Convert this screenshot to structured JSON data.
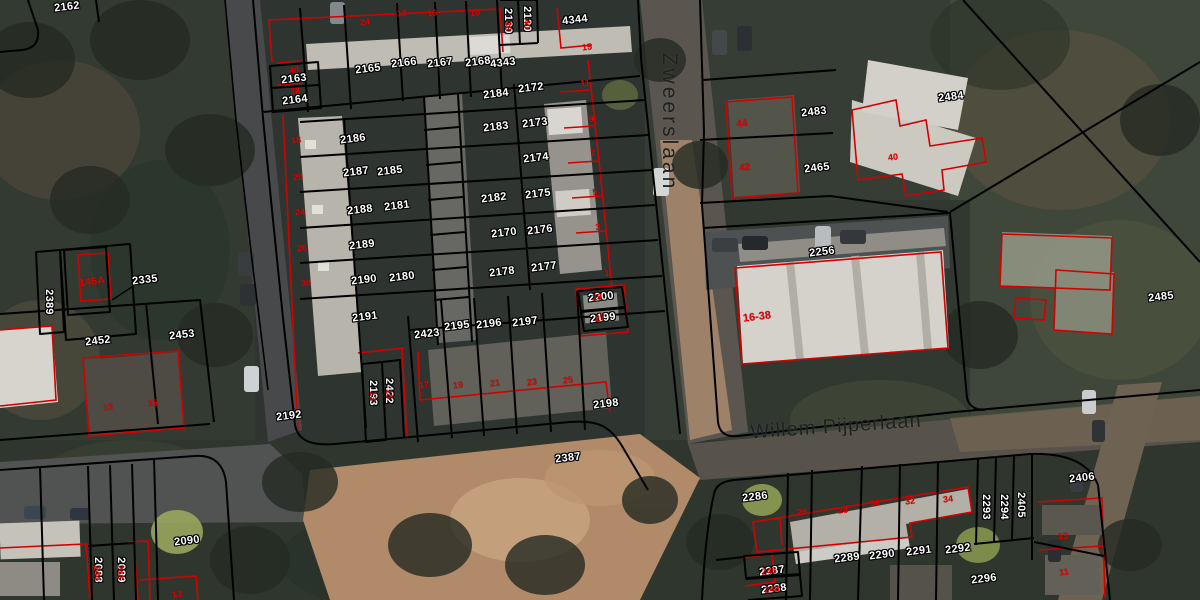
{
  "map": {
    "title": "Cadastral parcel map over aerial photo",
    "streets": [
      {
        "name": "Zweerslaan",
        "x": 669,
        "y": 122,
        "rot": 90
      },
      {
        "name": "Willem Pijperlaan",
        "x": 836,
        "y": 427,
        "rot": -4
      }
    ],
    "colors": {
      "parcel_line": "#000000",
      "building_line": "#d40000",
      "parcel_label": "#ffffff",
      "house_number": "#e10000",
      "street_text": "#1f2020",
      "sand_path": "#b08a69",
      "asphalt": "#4a4d4d"
    },
    "parcel_labels": [
      {
        "t": "2162",
        "x": 67,
        "y": 7
      },
      {
        "t": "2163",
        "x": 294,
        "y": 79
      },
      {
        "t": "2164",
        "x": 295,
        "y": 100
      },
      {
        "t": "2165",
        "x": 368,
        "y": 69
      },
      {
        "t": "2166",
        "x": 404,
        "y": 63
      },
      {
        "t": "2167",
        "x": 440,
        "y": 63
      },
      {
        "t": "2168",
        "x": 478,
        "y": 62
      },
      {
        "t": "4343",
        "x": 503,
        "y": 63
      },
      {
        "t": "4344",
        "x": 575,
        "y": 20
      },
      {
        "t": "2130",
        "x": 508,
        "y": 21,
        "r": 90
      },
      {
        "t": "2120",
        "x": 527,
        "y": 19,
        "r": 90
      },
      {
        "t": "2184",
        "x": 496,
        "y": 94
      },
      {
        "t": "2172",
        "x": 531,
        "y": 88
      },
      {
        "t": "2183",
        "x": 496,
        "y": 127
      },
      {
        "t": "2173",
        "x": 535,
        "y": 123
      },
      {
        "t": "2174",
        "x": 536,
        "y": 158
      },
      {
        "t": "2182",
        "x": 494,
        "y": 198
      },
      {
        "t": "2175",
        "x": 538,
        "y": 194
      },
      {
        "t": "2170",
        "x": 504,
        "y": 233
      },
      {
        "t": "2176",
        "x": 540,
        "y": 230
      },
      {
        "t": "2186",
        "x": 353,
        "y": 139
      },
      {
        "t": "2187",
        "x": 356,
        "y": 172
      },
      {
        "t": "2185",
        "x": 390,
        "y": 171
      },
      {
        "t": "2188",
        "x": 360,
        "y": 210
      },
      {
        "t": "2181",
        "x": 397,
        "y": 206
      },
      {
        "t": "2189",
        "x": 362,
        "y": 245
      },
      {
        "t": "2190",
        "x": 364,
        "y": 280
      },
      {
        "t": "2180",
        "x": 402,
        "y": 277
      },
      {
        "t": "2178",
        "x": 502,
        "y": 272
      },
      {
        "t": "2177",
        "x": 544,
        "y": 267
      },
      {
        "t": "2200",
        "x": 601,
        "y": 297
      },
      {
        "t": "2199",
        "x": 603,
        "y": 318
      },
      {
        "t": "2191",
        "x": 365,
        "y": 317
      },
      {
        "t": "2423",
        "x": 427,
        "y": 334
      },
      {
        "t": "2195",
        "x": 457,
        "y": 326
      },
      {
        "t": "2196",
        "x": 489,
        "y": 324
      },
      {
        "t": "2197",
        "x": 525,
        "y": 322
      },
      {
        "t": "2193",
        "x": 373,
        "y": 393,
        "r": 90
      },
      {
        "t": "2422",
        "x": 389,
        "y": 391,
        "r": 90
      },
      {
        "t": "2192",
        "x": 289,
        "y": 416
      },
      {
        "t": "2198",
        "x": 606,
        "y": 404
      },
      {
        "t": "2387",
        "x": 568,
        "y": 458
      },
      {
        "t": "2335",
        "x": 145,
        "y": 280
      },
      {
        "t": "2389",
        "x": 49,
        "y": 302,
        "r": 90
      },
      {
        "t": "2452",
        "x": 98,
        "y": 341
      },
      {
        "t": "2453",
        "x": 182,
        "y": 335
      },
      {
        "t": "2483",
        "x": 814,
        "y": 112
      },
      {
        "t": "2465",
        "x": 817,
        "y": 168
      },
      {
        "t": "2484",
        "x": 951,
        "y": 97
      },
      {
        "t": "2485",
        "x": 1161,
        "y": 297
      },
      {
        "t": "2256",
        "x": 822,
        "y": 252
      },
      {
        "t": "2286",
        "x": 755,
        "y": 497
      },
      {
        "t": "2287",
        "x": 772,
        "y": 571
      },
      {
        "t": "2288",
        "x": 774,
        "y": 589
      },
      {
        "t": "2289",
        "x": 847,
        "y": 558
      },
      {
        "t": "2290",
        "x": 882,
        "y": 555
      },
      {
        "t": "2291",
        "x": 919,
        "y": 551
      },
      {
        "t": "2292",
        "x": 958,
        "y": 549
      },
      {
        "t": "2293",
        "x": 986,
        "y": 507,
        "r": 90
      },
      {
        "t": "2294",
        "x": 1004,
        "y": 507,
        "r": 90
      },
      {
        "t": "2405",
        "x": 1021,
        "y": 505,
        "r": 90
      },
      {
        "t": "2406",
        "x": 1082,
        "y": 478
      },
      {
        "t": "2296",
        "x": 984,
        "y": 579
      },
      {
        "t": "2090",
        "x": 187,
        "y": 541
      },
      {
        "t": "2088",
        "x": 98,
        "y": 570,
        "r": 90
      },
      {
        "t": "2089",
        "x": 121,
        "y": 570,
        "r": 90
      }
    ],
    "house_number_labels": [
      {
        "t": "146A",
        "x": 92,
        "y": 282,
        "s": 11
      },
      {
        "t": "44",
        "x": 742,
        "y": 124,
        "s": 10
      },
      {
        "t": "42",
        "x": 745,
        "y": 168,
        "s": 10
      },
      {
        "t": "40",
        "x": 893,
        "y": 157
      },
      {
        "t": "16-38",
        "x": 757,
        "y": 317,
        "s": 11
      },
      {
        "t": "13",
        "x": 1063,
        "y": 536
      },
      {
        "t": "11",
        "x": 1064,
        "y": 572
      },
      {
        "t": "13",
        "x": 108,
        "y": 407
      },
      {
        "t": "15",
        "x": 153,
        "y": 403
      },
      {
        "t": "13",
        "x": 177,
        "y": 594
      },
      {
        "t": "11",
        "x": 585,
        "y": 83
      },
      {
        "t": "9",
        "x": 591,
        "y": 119
      },
      {
        "t": "7",
        "x": 593,
        "y": 153
      },
      {
        "t": "5",
        "x": 595,
        "y": 192
      },
      {
        "t": "3",
        "x": 598,
        "y": 227
      },
      {
        "t": "1",
        "x": 607,
        "y": 273
      },
      {
        "t": "18",
        "x": 296,
        "y": 140
      },
      {
        "t": "20",
        "x": 298,
        "y": 177
      },
      {
        "t": "24",
        "x": 300,
        "y": 212
      },
      {
        "t": "26",
        "x": 302,
        "y": 248
      },
      {
        "t": "30",
        "x": 306,
        "y": 283
      },
      {
        "t": "24",
        "x": 365,
        "y": 22
      },
      {
        "t": "18",
        "x": 402,
        "y": 13
      },
      {
        "t": "16",
        "x": 432,
        "y": 13
      },
      {
        "t": "10",
        "x": 475,
        "y": 13
      },
      {
        "t": "17",
        "x": 424,
        "y": 385
      },
      {
        "t": "19",
        "x": 458,
        "y": 385
      },
      {
        "t": "21",
        "x": 495,
        "y": 383
      },
      {
        "t": "23",
        "x": 532,
        "y": 382
      },
      {
        "t": "25",
        "x": 568,
        "y": 380
      },
      {
        "t": "26",
        "x": 802,
        "y": 512
      },
      {
        "t": "28",
        "x": 843,
        "y": 510
      },
      {
        "t": "30",
        "x": 875,
        "y": 503
      },
      {
        "t": "32",
        "x": 910,
        "y": 501
      },
      {
        "t": "34",
        "x": 948,
        "y": 499
      },
      {
        "t": "38",
        "x": 508,
        "y": 26,
        "r": 90
      },
      {
        "t": "40",
        "x": 527,
        "y": 24,
        "r": 90
      },
      {
        "t": "13",
        "x": 373,
        "y": 396,
        "r": 90
      },
      {
        "t": "15",
        "x": 389,
        "y": 394,
        "r": 90
      },
      {
        "t": "244",
        "x": 97,
        "y": 573,
        "r": 90
      },
      {
        "t": "246",
        "x": 120,
        "y": 572,
        "r": 90
      },
      {
        "t": "29",
        "x": 597,
        "y": 297
      },
      {
        "t": "27",
        "x": 600,
        "y": 318
      },
      {
        "t": "246",
        "x": 769,
        "y": 571
      },
      {
        "t": "248",
        "x": 772,
        "y": 589
      },
      {
        "t": "40",
        "x": 294,
        "y": 70
      },
      {
        "t": "38",
        "x": 295,
        "y": 91
      },
      {
        "t": "15",
        "x": 587,
        "y": 47
      }
    ]
  }
}
